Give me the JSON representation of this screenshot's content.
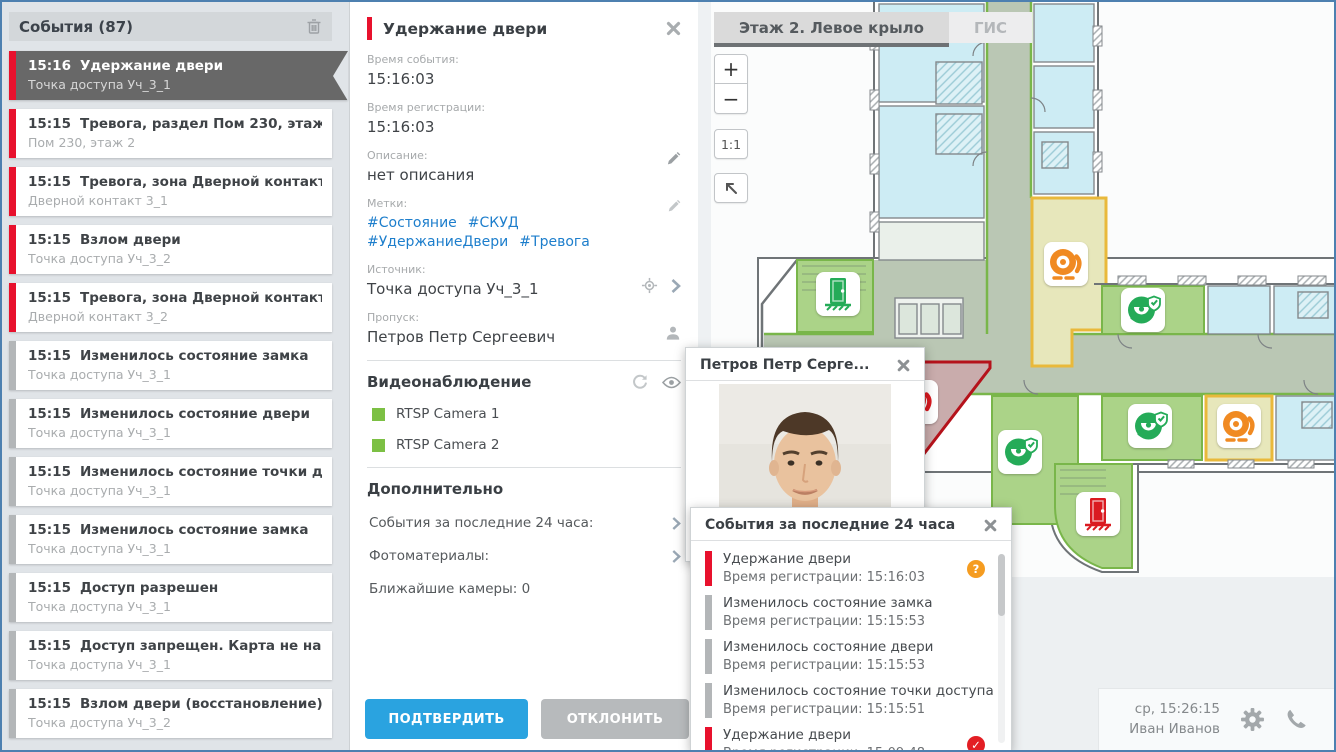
{
  "colors": {
    "alarm_red": "#e8112d",
    "info_gray": "#b3b6b8",
    "selected_gray": "#686868",
    "tag_blue": "#1d7ecc",
    "confirm_blue": "#2aa3e0",
    "decline_gray": "#b7babc",
    "camera_green": "#7cc044",
    "badge_orange": "#f59c20",
    "badge_red": "#e31e24",
    "icon_orange": "#f08a22",
    "icon_green": "#25ab58",
    "icon_red": "#da1a21",
    "map_cyan": "#cdecf4",
    "map_room_green": "#abd388",
    "map_corridor": "#bac7b4",
    "map_yellow": "#e7e7bb",
    "map_yellow_border": "#e9b93b",
    "map_red_room": "#c9acac",
    "map_red_border": "#b5121b",
    "map_green_edge": "#79b64a"
  },
  "sidebar": {
    "title": "События (87)",
    "events": [
      {
        "time": "15:16",
        "title": "Удержание двери",
        "subtitle": "Точка доступа Уч_3_1",
        "classes": "alarm selected"
      },
      {
        "time": "15:15",
        "title": "Тревога, раздел Пом 230, этаж 2",
        "subtitle": "Пом 230, этаж 2",
        "classes": "alarm"
      },
      {
        "time": "15:15",
        "title": "Тревога, зона Дверной контакт ...",
        "subtitle": "Дверной контакт 3_1",
        "classes": "alarm"
      },
      {
        "time": "15:15",
        "title": "Взлом двери",
        "subtitle": "Точка доступа Уч_3_2",
        "classes": "alarm"
      },
      {
        "time": "15:15",
        "title": "Тревога, зона Дверной контакт ...",
        "subtitle": "Дверной контакт 3_2",
        "classes": "alarm"
      },
      {
        "time": "15:15",
        "title": "Изменилось состояние замка",
        "subtitle": "Точка доступа Уч_3_1",
        "classes": "info"
      },
      {
        "time": "15:15",
        "title": "Изменилось состояние двери",
        "subtitle": "Точка доступа Уч_3_1",
        "classes": "info"
      },
      {
        "time": "15:15",
        "title": "Изменилось состояние точки д...",
        "subtitle": "Точка доступа Уч_3_1",
        "classes": "info"
      },
      {
        "time": "15:15",
        "title": "Изменилось состояние замка",
        "subtitle": "Точка доступа Уч_3_1",
        "classes": "info"
      },
      {
        "time": "15:15",
        "title": "Доступ разрешен",
        "subtitle": "Точка доступа Уч_3_1",
        "classes": "info"
      },
      {
        "time": "15:15",
        "title": "Доступ запрещен. Карта не най...",
        "subtitle": "Точка доступа Уч_3_1",
        "classes": "info"
      },
      {
        "time": "15:15",
        "title": "Взлом двери (восстановление)",
        "subtitle": "Точка доступа Уч_3_2",
        "classes": "info"
      }
    ]
  },
  "detail": {
    "title": "Удержание двери",
    "event_time_label": "Время события:",
    "event_time": "15:16:03",
    "reg_time_label": "Время регистрации:",
    "reg_time": "15:16:03",
    "description_label": "Описание:",
    "description": "нет описания",
    "tags_label": "Метки:",
    "tags": [
      "#Состояние",
      "#СКУД",
      "#УдержаниеДвери",
      "#Тревога"
    ],
    "source_label": "Источник:",
    "source": "Точка доступа Уч_3_1",
    "pass_label": "Пропуск:",
    "pass_holder": "Петров Петр Сергеевич",
    "video_title": "Видеонаблюдение",
    "cameras": [
      {
        "name": "RTSP Camera 1"
      },
      {
        "name": "RTSP Camera 2"
      }
    ],
    "extra_title": "Дополнительно",
    "extra_items": [
      {
        "label": "События за последние 24 часа:"
      },
      {
        "label": "Фотоматериалы:"
      }
    ],
    "nearest_cameras": "Ближайшие камеры: 0",
    "confirm_label": "ПОДТВЕРДИТЬ",
    "decline_label": "ОТКЛОНИТЬ"
  },
  "map": {
    "tabs": [
      {
        "label": "Этаж 2. Левое крыло",
        "active": true
      },
      {
        "label": "ГИС",
        "active": false
      }
    ],
    "zoom_in": "+",
    "zoom_out": "−",
    "zoom_reset": "1:1",
    "icons": [
      {
        "type": "door",
        "color": "green",
        "x": 140,
        "y": 292,
        "name": "map-door-ok-icon"
      },
      {
        "type": "bell",
        "color": "orange",
        "x": 368,
        "y": 262,
        "name": "map-alarm-warning-icon"
      },
      {
        "type": "camera",
        "color": "green",
        "x": 445,
        "y": 308,
        "name": "map-camera-guard-icon"
      },
      {
        "type": "bell",
        "color": "red",
        "x": 218,
        "y": 400,
        "name": "map-alarm-active-icon"
      },
      {
        "type": "camera",
        "color": "green",
        "x": 322,
        "y": 450,
        "name": "map-camera-guard-icon"
      },
      {
        "type": "camera",
        "color": "green",
        "x": 452,
        "y": 424,
        "name": "map-camera-guard-icon"
      },
      {
        "type": "bell",
        "color": "orange",
        "x": 541,
        "y": 424,
        "name": "map-alarm-warning-icon"
      },
      {
        "type": "door",
        "color": "red",
        "x": 400,
        "y": 512,
        "name": "map-door-alarm-icon"
      }
    ]
  },
  "photo_popup": {
    "title": "Петров Петр Серге..."
  },
  "events_popup": {
    "title": "События за последние 24 часа",
    "events": [
      {
        "title": "Удержание двери",
        "reg": "Время регистрации: 15:16:03",
        "classes": "alarm",
        "badge_char": "?",
        "badge_type": "badge-question"
      },
      {
        "title": "Изменилось состояние замка",
        "reg": "Время регистрации: 15:15:53",
        "classes": "info"
      },
      {
        "title": "Изменилось состояние двери",
        "reg": "Время регистрации: 15:15:53",
        "classes": "info"
      },
      {
        "title": "Изменилось состояние точки доступа",
        "reg": "Время регистрации: 15:15:51",
        "classes": "info"
      },
      {
        "title": "Удержание двери",
        "reg": "Время регистрации: 15:09:48",
        "classes": "alarm",
        "badge_char": "✓",
        "badge_type": "badge-check"
      }
    ]
  },
  "status_bar": {
    "datetime": "ср, 15:26:15",
    "user": "Иван Иванов"
  }
}
